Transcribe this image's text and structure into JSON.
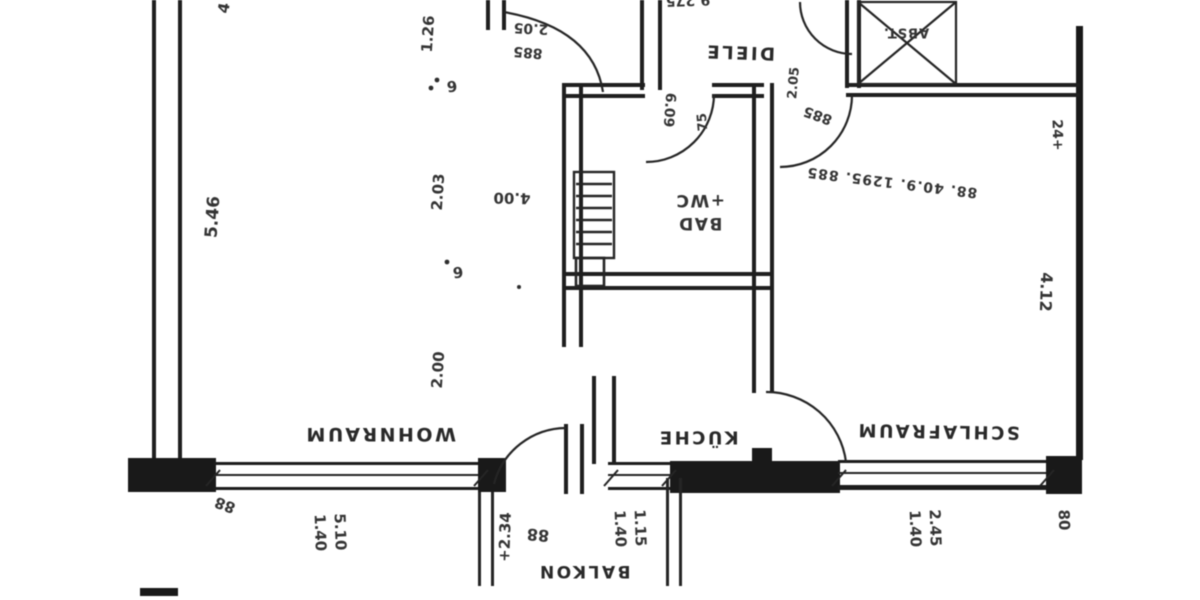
{
  "rooms": {
    "wohnraum": "WOHNRAUM",
    "kueche": "KÜCHE",
    "schlafraum": "SCHLAFRAUM",
    "diele": "DIELE",
    "bad_line1": "BAD",
    "bad_line2": "+WC",
    "balkon": "BALKON",
    "abstellraum": "ABST."
  },
  "dimensions": {
    "left_wall": "5.46",
    "right_wall": "4.12",
    "chain_left_1": "1.26",
    "chain_left_2": "6",
    "chain_left_3": "2.03",
    "chain_left_4": "6",
    "chain_left_5": "2.00",
    "bath_width": "4.00",
    "top_chain": "88. 40.9. 1295. 885",
    "entrance_door_height": "2.05",
    "entrance_door_width": "885",
    "schlafraum_door_height": "2.05",
    "schlafraum_door_width": "885",
    "bad_door_a": "6.09",
    "bad_door_b": "75",
    "wohnraum_window_w": "5.10",
    "wohnraum_window_h": "1.40",
    "kueche_window_w": "1.15",
    "kueche_window_h": "1.40",
    "schlafraum_window_w": "2.45",
    "schlafraum_window_h": "1.40",
    "balkon_height": "+2.34",
    "balkon_mark": "88",
    "corner_left": "88",
    "corner_right": "80",
    "corner_top_right": "24+",
    "top_edge_partial": "9.275",
    "top_left_partial": "4"
  },
  "colors": {
    "ink": "#242424",
    "paper": "#ffffff"
  }
}
